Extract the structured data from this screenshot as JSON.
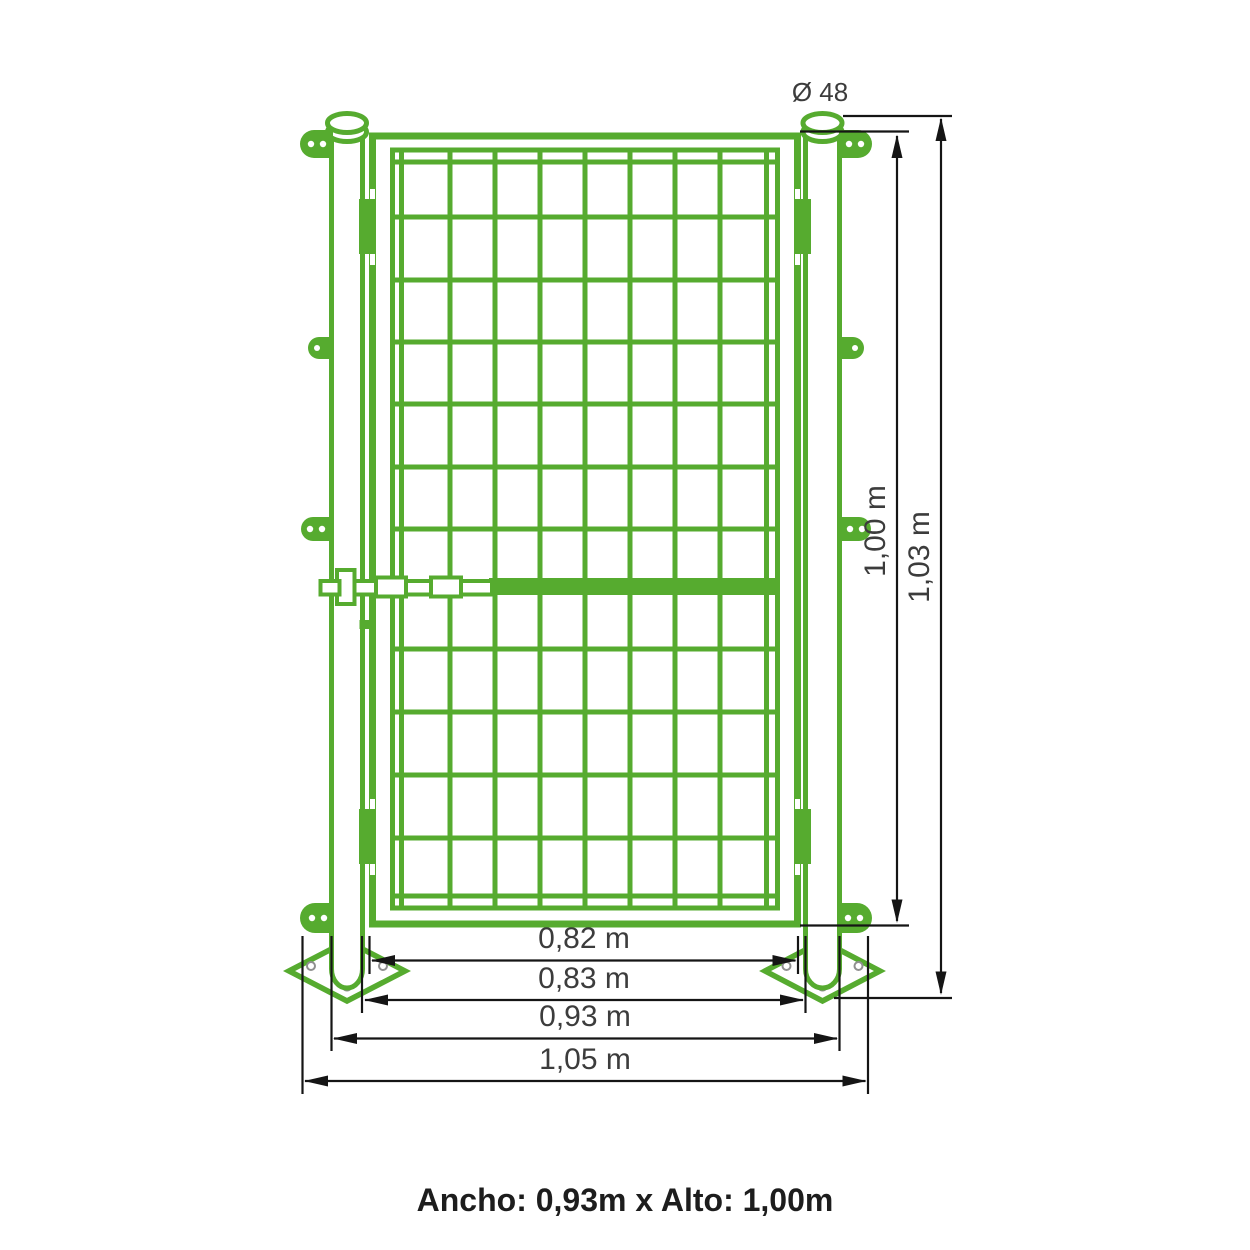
{
  "diagram": {
    "diameter_label": "Ø 48",
    "title": "Ancho: 0,93m x Alto: 1,00m",
    "colors": {
      "gate_green": "#56ab2f",
      "dimension_lines": "#151515",
      "dimension_text": "#3c3c3c",
      "title_text": "#1d1d1d"
    },
    "dimensions": {
      "height_gate": "1,00 m",
      "height_total": "1,03 m",
      "width_opening": "0,82 m",
      "width_between_posts": "0,83 m",
      "width_gate": "0,93 m",
      "width_total": "1,05 m"
    }
  }
}
